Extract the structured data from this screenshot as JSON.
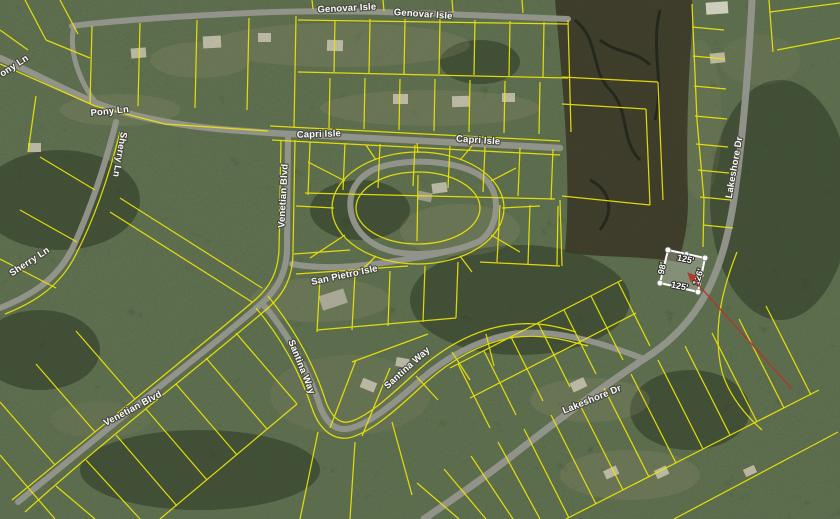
{
  "streets": [
    {
      "id": "genovar-isle-a",
      "text": "Genovar Isle"
    },
    {
      "id": "genovar-isle-b",
      "text": "Genovar Isle"
    },
    {
      "id": "pony-ln-a",
      "text": "Pony Ln"
    },
    {
      "id": "pony-ln-b",
      "text": "Pony Ln"
    },
    {
      "id": "sherry-ln-a",
      "text": "Sherry Ln"
    },
    {
      "id": "sherry-ln-b",
      "text": "Sherry Ln"
    },
    {
      "id": "capri-isle-a",
      "text": "Capri Isle"
    },
    {
      "id": "capri-isle-b",
      "text": "Capri Isle"
    },
    {
      "id": "venetian-blvd-a",
      "text": "Venetian Blvd"
    },
    {
      "id": "venetian-blvd-b",
      "text": "Venetian Blvd"
    },
    {
      "id": "san-pietro-isle",
      "text": "San Pietro Isle"
    },
    {
      "id": "santina-way-a",
      "text": "Santina Way"
    },
    {
      "id": "santina-way-b",
      "text": "Santina Way"
    },
    {
      "id": "lakeshore-dr-a",
      "text": "Lakeshore Dr"
    },
    {
      "id": "lakeshore-dr-b",
      "text": "Lakeshore Dr"
    }
  ],
  "selected_parcel": {
    "edge_top": "125'",
    "edge_left": "98'",
    "edge_bottom": "125'",
    "edge_right": "126'"
  },
  "colors": {
    "parcel_line": "#ece409",
    "selection_outline": "#ffffff",
    "arrow": "#b63326",
    "road": "#95968e",
    "label_fill": "#ffffff"
  }
}
